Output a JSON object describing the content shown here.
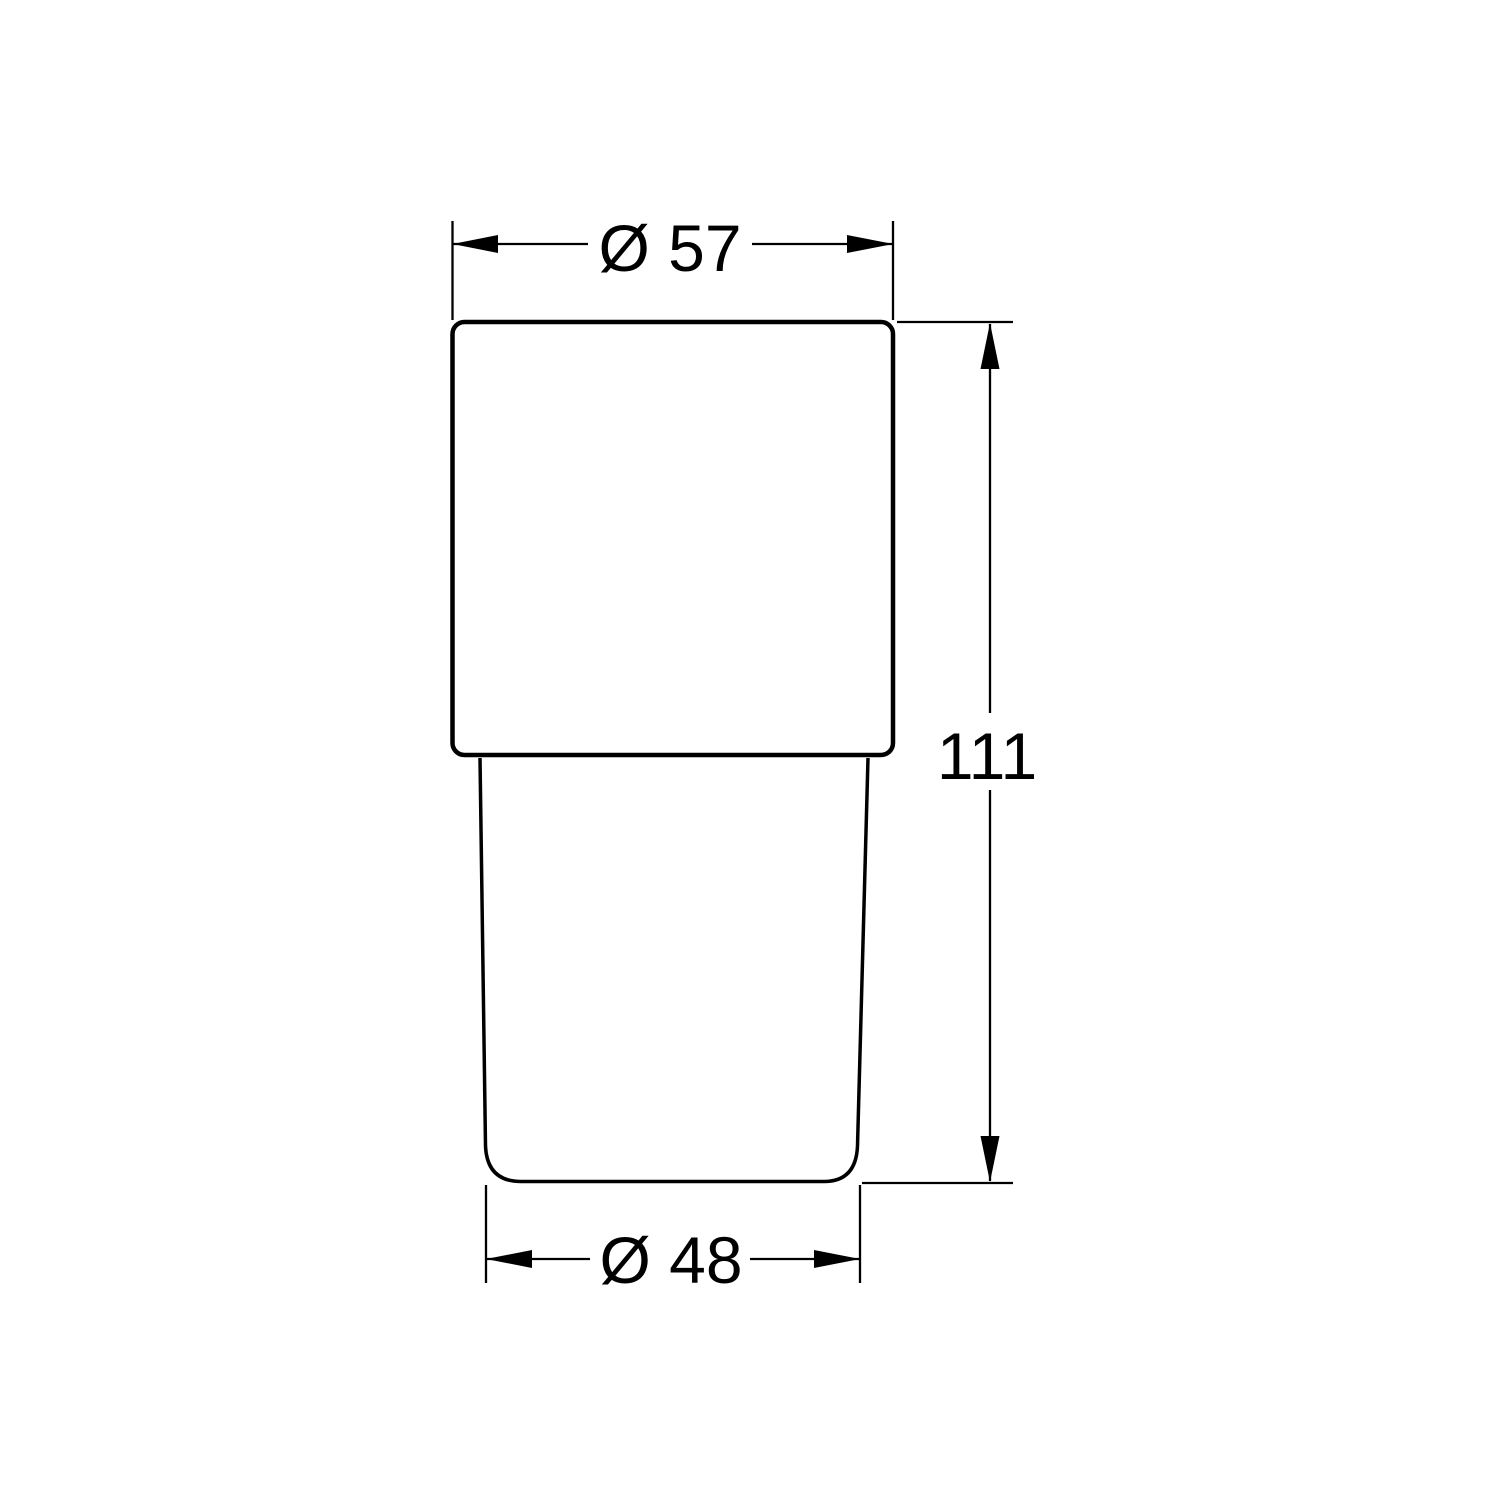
{
  "drawing": {
    "background_color": "#ffffff",
    "line_color": "#000000",
    "dimensions": {
      "top_diameter": {
        "label": "Ø 57",
        "value": 57
      },
      "height": {
        "label": "111",
        "value": 111
      },
      "bottom_diameter": {
        "label": "Ø 48",
        "value": 48
      }
    }
  }
}
